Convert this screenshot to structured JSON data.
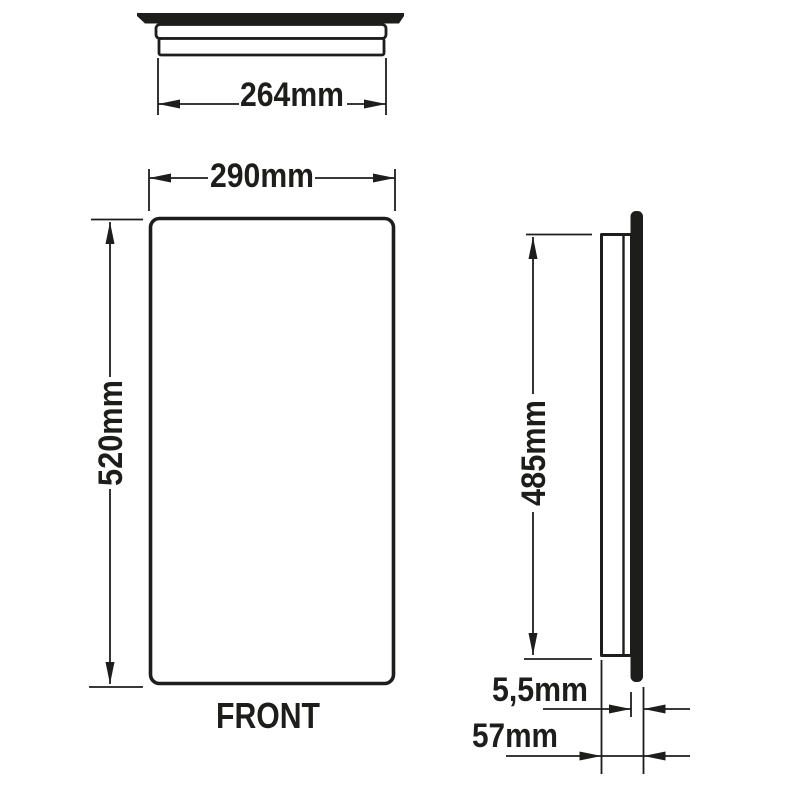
{
  "drawing": {
    "background_color": "#ffffff",
    "ink_color": "#1d1d1b",
    "caption": "FRONT",
    "dimensions": {
      "top_width": "264mm",
      "front_width": "290mm",
      "front_height": "520mm",
      "side_height": "485mm",
      "panel_thickness": "5,5mm",
      "depth": "57mm"
    }
  }
}
